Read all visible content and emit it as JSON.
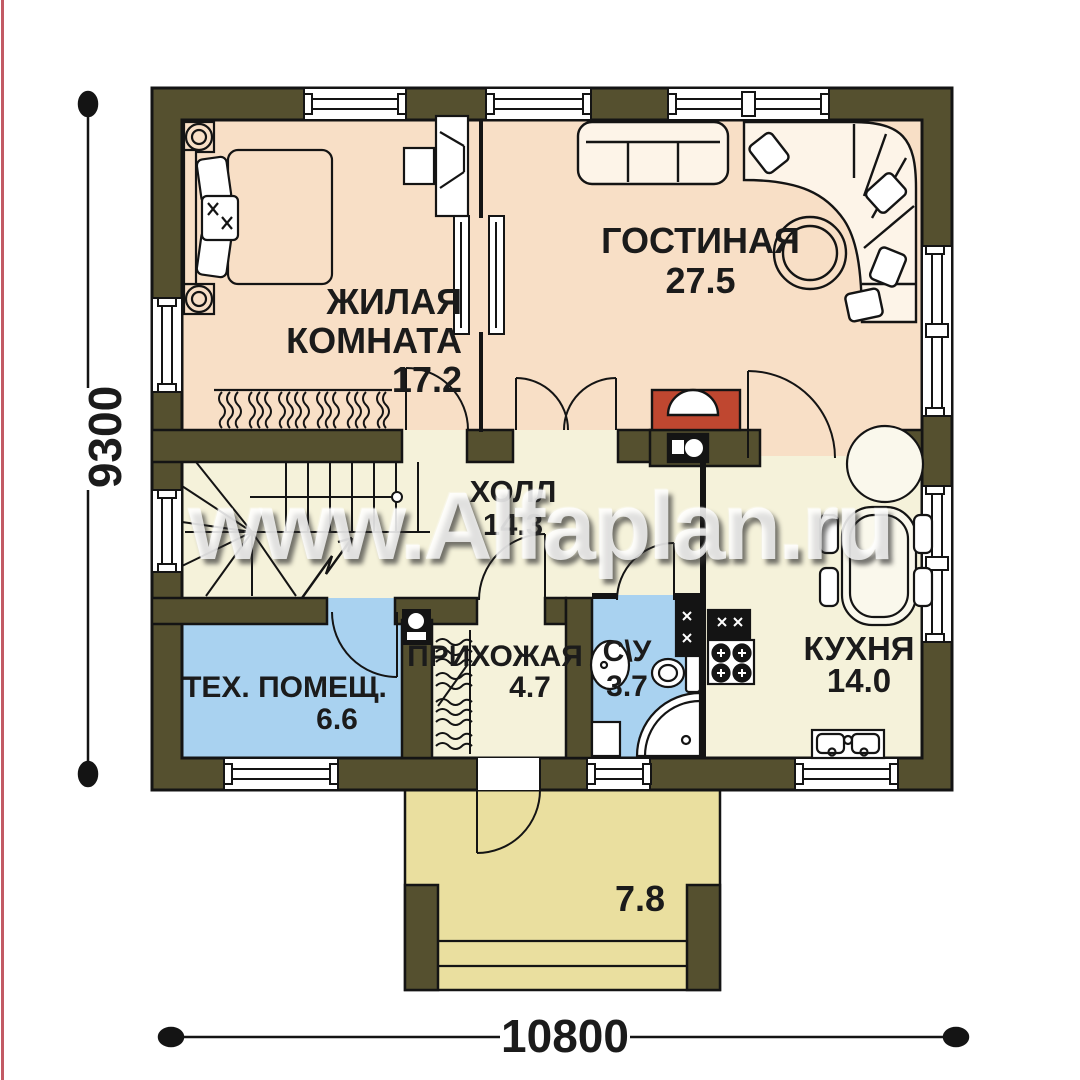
{
  "watermark": {
    "text": "www.Alfaplan.ru"
  },
  "dimensions": {
    "width_label": "10800",
    "height_label": "9300"
  },
  "rooms": {
    "bedroom": {
      "line1": "ЖИЛАЯ",
      "line2": "КОМНАТА",
      "area": "17.2"
    },
    "living": {
      "name": "ГОСТИНАЯ",
      "area": "27.5"
    },
    "hall": {
      "name": "ХОЛЛ",
      "area": "14.3"
    },
    "tech": {
      "name": "ТЕХ. ПОМЕЩ.",
      "area": "6.6"
    },
    "entry": {
      "name": "ПРИХОЖАЯ",
      "area": "4.7"
    },
    "wc": {
      "name": "С\\У",
      "area": "3.7"
    },
    "kitchen": {
      "name": "КУХНЯ",
      "area": "14.0"
    },
    "porch": {
      "area": "7.8"
    }
  },
  "colors": {
    "wall": "#55502f",
    "floor_warm": "#f8dfc6",
    "floor_cream": "#f5f2da",
    "floor_blue": "#a9d2f0",
    "floor_porch": "#eadf9f",
    "fireplace": "#bf4730",
    "edge_line": "#c25a64",
    "outline": "#141414"
  }
}
